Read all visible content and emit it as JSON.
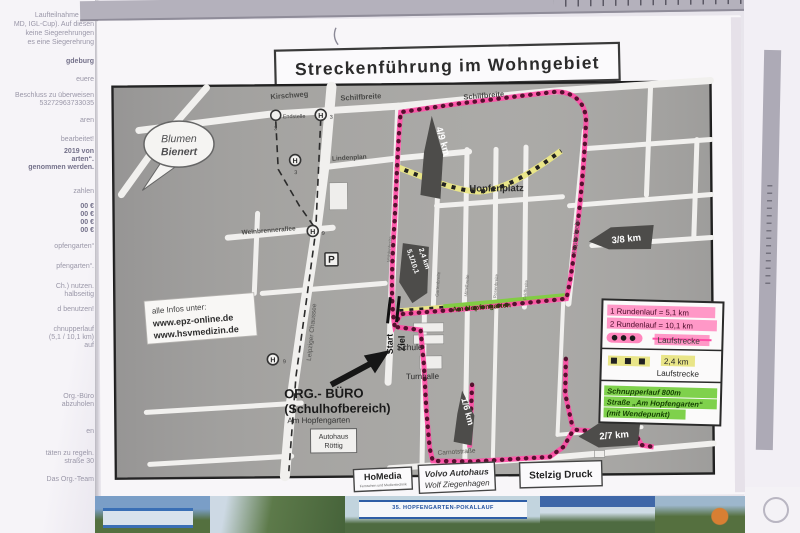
{
  "page": {
    "title": "Streckenführung im Wohngebiet"
  },
  "map": {
    "streets": {
      "kirschweg": "Kirschweg",
      "schilfbreite": "Schilfbreite",
      "lindenplan": "Lindenplan",
      "weinbrennerallee": "Weinbrennerallee",
      "leipziger_chaussee": "Leipziger Chaussee",
      "hopfenbreite": "Hopfenbreite",
      "am_hopfengarten": "Am Hopfengarten",
      "carnotstrasse": "Carnotstraße",
      "hopfenplatz": "Hopfenplatz",
      "endstelle": "Endstelle"
    },
    "minor_streets": [
      "Mühlenbreite",
      "Gartenbreite",
      "Mittelbreite",
      "Rosenbreite",
      "Feldbreite"
    ],
    "stops": {
      "h": "H",
      "p": "P",
      "line3": "3",
      "line9": "9"
    },
    "pois": {
      "blumen1": "Blumen",
      "blumen2": "Bienert",
      "schule": "Schule",
      "turnhalle": "Turnhalle",
      "autohaus1": "Autohaus",
      "autohaus2": "Röttig",
      "org1": "ORG.- BÜRO",
      "org2": "(Schulhofbereich)",
      "org3": "Am Hopfengarten",
      "start": "Start",
      "ziel": "Ziel"
    },
    "info_box": {
      "line1": "alle Infos unter:",
      "line2": "www.epz-online.de",
      "line3": "www.hsvmedizin.de"
    },
    "markers": {
      "k49": "4/9 km",
      "k38": "3/8 km",
      "k51": "5,1/10,1",
      "k24": "2,4 km",
      "k16": "1/6 km",
      "k27": "2/7 km"
    }
  },
  "legend": {
    "round1": "1 Rundenlauf = 5,1 km",
    "round2": "2 Rundenlauf = 10,1 km",
    "lauf1": "Laufstrecke",
    "km24": "2,4 km",
    "lauf2": "Laufstrecke",
    "schnupper1": "Schnupperlauf 800m",
    "schnupper2": "Straße „Am Hopfengarten“",
    "schnupper3": "(mit Wendepunkt)"
  },
  "sponsors": {
    "homedia": "HoMedia",
    "homedia_sub": "Fernsehen und Medientechnik",
    "volvo1": "Volvo Autohaus",
    "volvo2": "Wolf Ziegenhagen",
    "stelzig": "Stelzig Druck"
  },
  "left_sheet": {
    "fragments": [
      "Laufteilnahme eine",
      "MD, IGL-Cup). Auf diesen",
      "keine Siegerehrungen",
      "es eine Siegerehrung",
      "gdeburg",
      "euere",
      "Beschluss zu überweisen",
      "53272963733035",
      "aren",
      "bearbeitet!",
      "2019 von",
      "arten“.",
      "genommen werden.",
      "zahlen",
      "00 €",
      "00 €",
      "00 €",
      "00 €",
      "opfengarten“",
      "pfengarten“.",
      "Ch.) nutzen.",
      "halbseitig",
      "d benutzen!",
      "chnupperlauf",
      "(5,1 / 10,1 km)",
      "auf",
      "Org.-Büro",
      "abzuholen",
      "en",
      "täten zu regeln.",
      "straße 30",
      "Das Org.-Team"
    ]
  },
  "photo": {
    "banner_bottom": "35. HOPFENGARTEN-POKALLAUF"
  },
  "colors": {
    "route_pink": "#ff4da6",
    "route_dot": "#55102e",
    "route_yellow": "#e9e588",
    "route_green": "#82cc44",
    "marker_gray": "#4d4c4a",
    "highlight_pink": "#ff86bd",
    "highlight_yellow": "#e9e588",
    "highlight_green": "#7fd14c"
  }
}
